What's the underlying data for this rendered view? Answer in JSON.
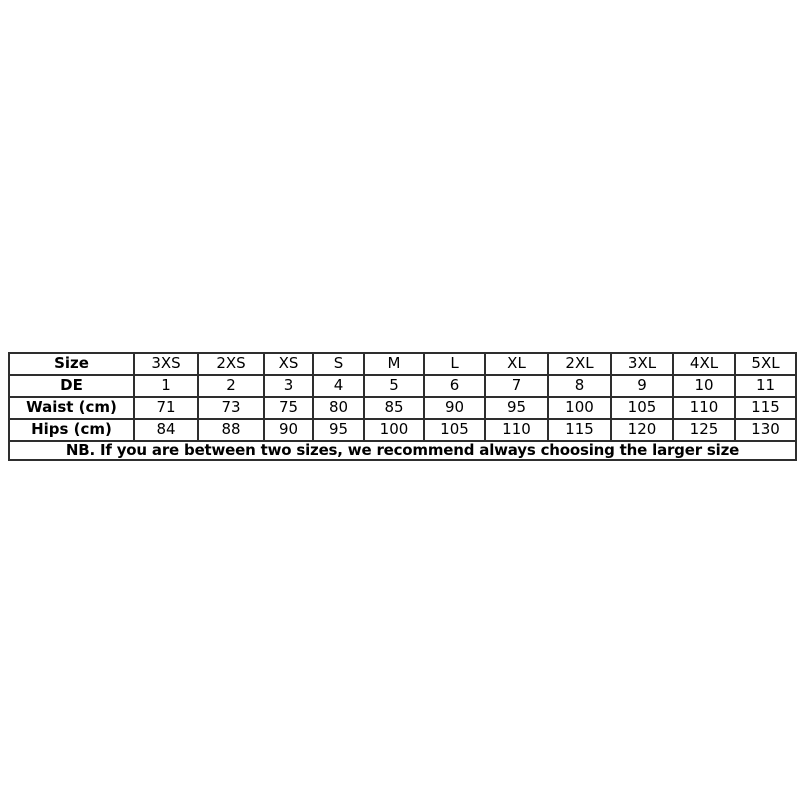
{
  "colors": {
    "background": "#ffffff",
    "border": "#2e2e2e",
    "text": "#000000"
  },
  "chart_data": {
    "type": "table",
    "title": "Clothing size chart",
    "columns": [
      "Size",
      "3XS",
      "2XS",
      "XS",
      "S",
      "M",
      "L",
      "XL",
      "2XL",
      "3XL",
      "4XL",
      "5XL"
    ],
    "rows": [
      [
        "DE",
        "1",
        "2",
        "3",
        "4",
        "5",
        "6",
        "7",
        "8",
        "9",
        "10",
        "11"
      ],
      [
        "Waist (cm)",
        "71",
        "73",
        "75",
        "80",
        "85",
        "90",
        "95",
        "100",
        "105",
        "110",
        "115"
      ],
      [
        "Hips (cm)",
        "84",
        "88",
        "90",
        "95",
        "100",
        "105",
        "110",
        "115",
        "120",
        "125",
        "130"
      ]
    ],
    "note": "NB. If you are between two sizes, we recommend always choosing the larger size",
    "layout_hints": {
      "grid": "all-borders",
      "row_label_style": "bold",
      "note_style": "bold, merged full-width row"
    }
  }
}
